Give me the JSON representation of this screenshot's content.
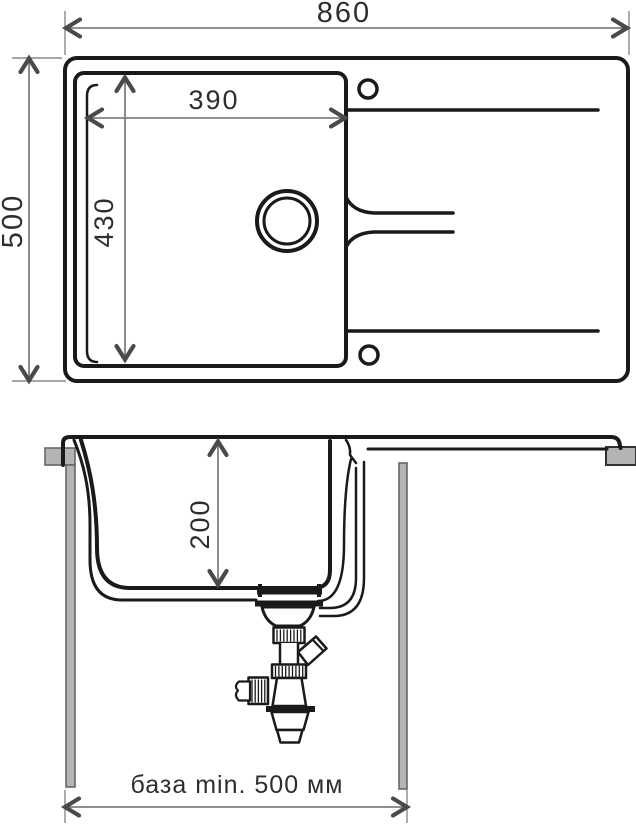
{
  "top_view": {
    "overall_width_label": "860",
    "overall_depth_label": "500",
    "bowl_width_label": "390",
    "bowl_length_label": "430"
  },
  "section_view": {
    "bowl_depth_label": "200",
    "cabinet_min_width_label": "база min. 500 мм"
  },
  "colors": {
    "outline": "#1a1a1a",
    "dimension_line": "#7f7f7f",
    "arrowhead": "#4a4a4a",
    "cabinet_fill": "#b4b4b4",
    "background": "#ffffff"
  }
}
